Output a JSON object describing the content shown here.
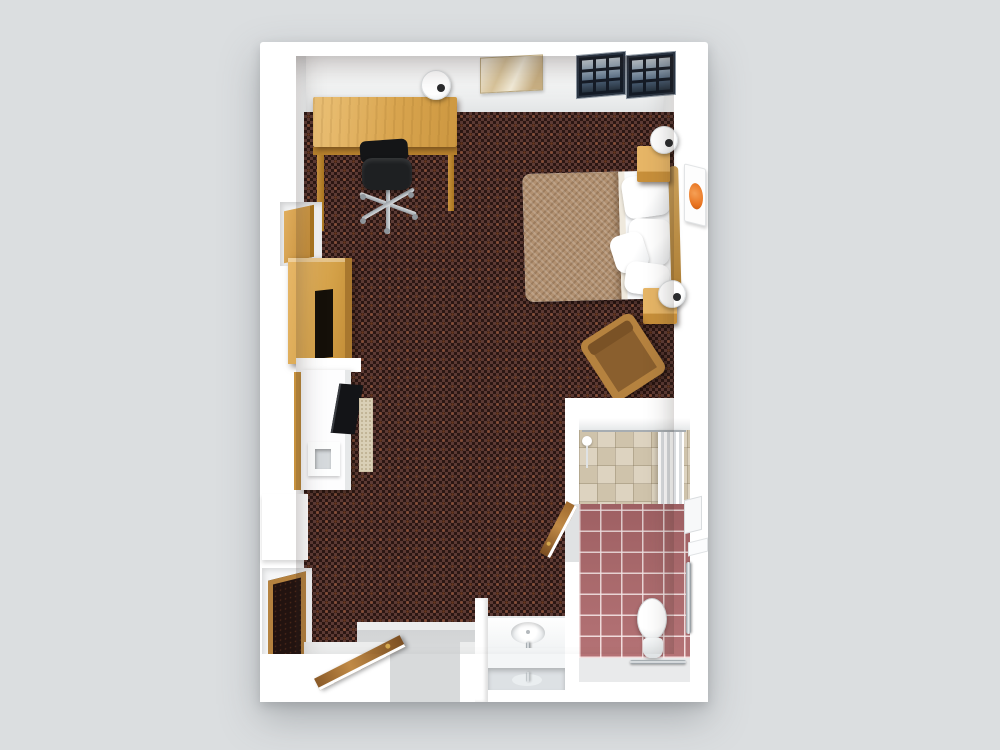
{
  "scene": {
    "title": "3D floor plan of a hotel studio guest room with accessible bathroom",
    "style": "top-down 3D architectural render",
    "view": "overhead isometric"
  },
  "palette": {
    "background": "#dbdee0",
    "wall": "#ffffff",
    "wall-shade": "#e3e5e6",
    "carpet-dark": "#2c1713",
    "carpet-light": "#5c3a34",
    "carpet-speck": "#c86a3a",
    "wood": "#d9a54f",
    "wood-dark": "#b9832e",
    "blanket": "#b19070",
    "tile-pink": "#b06b6e",
    "tile-shower": "#d8cdbb",
    "window-frame": "#141b26",
    "window-glass": "#8fa3b5",
    "accent-orange": "#e8731f",
    "chrome": "#c3c9cd",
    "chair-black": "#1e2022",
    "armchair-cushion": "#8a5f2e",
    "entry-floor": "#d8dadb"
  },
  "rooms": {
    "main": {
      "label": "Bedroom and living area",
      "floor": "dark red patterned carpet"
    },
    "bathroom": {
      "label": "Bathroom",
      "floor_main": "pink ceramic tile",
      "floor_shower": "beige stone tile"
    },
    "entry": {
      "label": "Entry vestibule",
      "floor": "light gray hard floor"
    },
    "vanity": {
      "label": "Sink vanity alcove"
    }
  },
  "furniture": {
    "desk": {
      "label": "Wooden desk"
    },
    "office_chair": {
      "label": "Black office chair with casters"
    },
    "desk_lamp": {
      "label": "White table lamp on desk"
    },
    "art_top": {
      "label": "Abstract beige artwork on top wall"
    },
    "window_left": {
      "label": "Gridded window, left panel"
    },
    "window_right": {
      "label": "Gridded window, right panel"
    },
    "bed": {
      "label": "Double bed with tan blanket and white pillows"
    },
    "headboard": {
      "label": "Curved wood headboard"
    },
    "nightstand_top": {
      "label": "Wooden nightstand, head side"
    },
    "nightstand_bottom": {
      "label": "Wooden nightstand, foot side"
    },
    "lamp_top": {
      "label": "White bedside lamp"
    },
    "lamp_bottom": {
      "label": "White bedside lamp"
    },
    "art_orange": {
      "label": "Orange circle artwork on right wall"
    },
    "armchair": {
      "label": "Wooden armchair with brown cushion"
    },
    "shelf_upper": {
      "label": "Wooden wall shelf in niche"
    },
    "media_cabinet": {
      "label": "Wooden media cabinet with TV slot"
    },
    "kitchen_counter": {
      "label": "White kitchenette counter"
    },
    "tv": {
      "label": "Flat screen TV"
    },
    "floor_mat": {
      "label": "Beige floor mat"
    },
    "mini_fridge": {
      "label": "Mini fridge"
    },
    "leaning_mirror": {
      "label": "Wood framed leaning mirror"
    },
    "entry_door": {
      "label": "Open wooden entry door"
    },
    "bathroom_door": {
      "label": "Open wooden bathroom door"
    },
    "shower": {
      "label": "Roll-in shower with beige tile"
    },
    "shower_curtain": {
      "label": "White pleated shower curtain"
    },
    "shower_head": {
      "label": "Handheld shower head"
    },
    "toilet": {
      "label": "White toilet"
    },
    "towel_bar": {
      "label": "Chrome grab bar behind toilet"
    },
    "grab_bar": {
      "label": "Chrome vertical grab bar"
    },
    "sink": {
      "label": "Vanity sink with chrome faucet"
    },
    "vanity_mirror": {
      "label": "Vanity mirror"
    }
  }
}
